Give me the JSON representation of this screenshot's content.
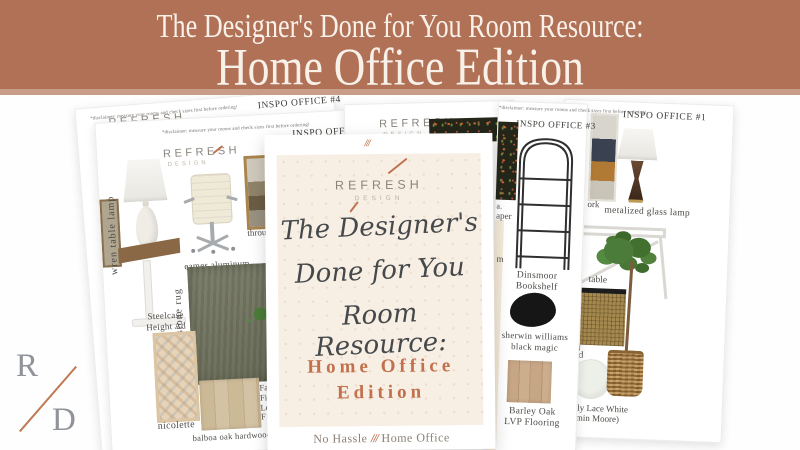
{
  "banner": {
    "line1": "The Designer's Done for You Room Resource:",
    "line2": "Home Office Edition"
  },
  "brand": {
    "name": "REFRESH",
    "sub": "DESIGN"
  },
  "monogram": {
    "r": "R",
    "d": "D"
  },
  "cover": {
    "slashes": "///",
    "script1": "The Designer's",
    "script2": "Done for You",
    "script3": "Room Resource:",
    "edition1": "Home Office",
    "edition2": "Edition",
    "tag_left": "No Hassle",
    "tag_slashes": "///",
    "tag_right": "Home Office"
  },
  "boards": {
    "office4": {
      "disclaimer": "*disclaimer: measure your rooms and check sizes first before ordering!",
      "title": "INSPO OFFICE #4"
    },
    "office2": {
      "disclaimer": "*disclaimer: measure your rooms and check sizes first before ordering!",
      "title": "INSPO OFFIC"
    },
    "office3": {
      "disclaimer": "*disclaimer: measure your rooms and check sizes first before ordering!",
      "title": "INSPO OFFICE #3"
    },
    "office1": {
      "title": "INSPO OFFICE #1"
    }
  },
  "items": {
    "wren": "wren table lamp",
    "eames_l1": "eames aluminum",
    "eames_l2": "group chair",
    "art_frag": "throug",
    "steelcase_l1": "Steelcase",
    "steelcase_l2": "Height Ad",
    "kennedy": "kennedy bluestone rug",
    "nicolette": "nicolette",
    "balboa": "balboa oak hardwood",
    "cutoff_lines": [
      "Fa",
      "Fid",
      "Lo",
      "F"
    ],
    "wallpaper_frag1": "a.",
    "wallpaper_frag2": "aper",
    "wallpaper_frag3": "m",
    "dinsmoor_l1": "Dinsmoor",
    "dinsmoor_l2": "Bookshelf",
    "artwork_frag": "ork",
    "sherwin_l1": "sherwin williams",
    "sherwin_l2": "black magic",
    "barley_l1": "Barley Oak",
    "barley_l2": "LVP Flooring",
    "metalized": "metalized glass lamp",
    "table_frag": "table",
    "sideboard_frag": "board",
    "paint_l1": "tilly Lace White",
    "paint_l2": "jamin Moore)"
  },
  "colors": {
    "banner_bg": "#b17156",
    "accent": "#c0714f",
    "card_bg": "#f8efe4"
  }
}
